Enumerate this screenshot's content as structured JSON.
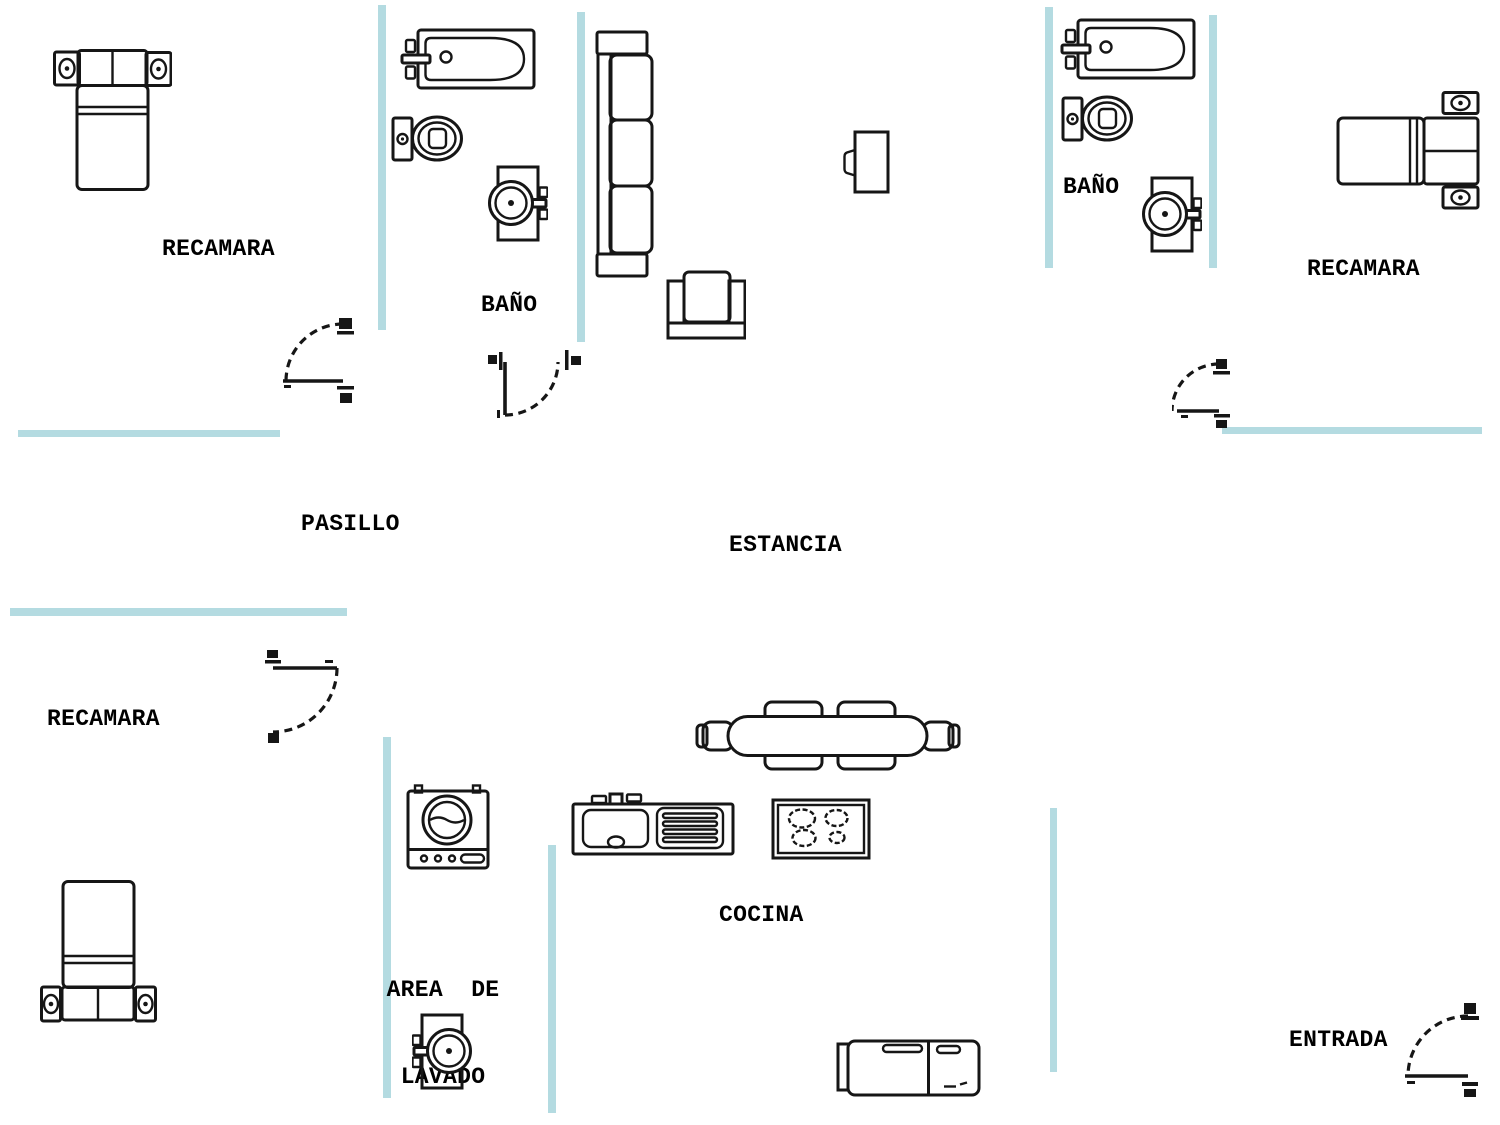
{
  "colors": {
    "wall": "#b4dbe1",
    "line": "#161616",
    "text": "#000000",
    "background": "#ffffff"
  },
  "labels": {
    "recamara_top_left": "RECAMARA",
    "bano_left": "BAÑO",
    "estancia": "ESTANCIA",
    "bano_right": "BAÑO",
    "recamara_top_right": "RECAMARA",
    "pasillo": "PASILLO",
    "recamara_mid_left": "RECAMARA",
    "area_lavado_line1": "AREA  DE",
    "area_lavado_line2": "LAVADO",
    "cocina": "COCINA",
    "entrada": "ENTRADA"
  },
  "icons": [
    "double-bed-icon",
    "nightstand-lamp-icon",
    "bathtub-icon",
    "toilet-icon",
    "pedestal-sink-icon",
    "sofa-icon",
    "armchair-icon",
    "tv-icon",
    "washing-machine-icon",
    "kitchen-sink-icon",
    "cooktop-icon",
    "dining-table-icon",
    "refrigerator-icon",
    "door-swing-icon",
    "wall-segment"
  ]
}
